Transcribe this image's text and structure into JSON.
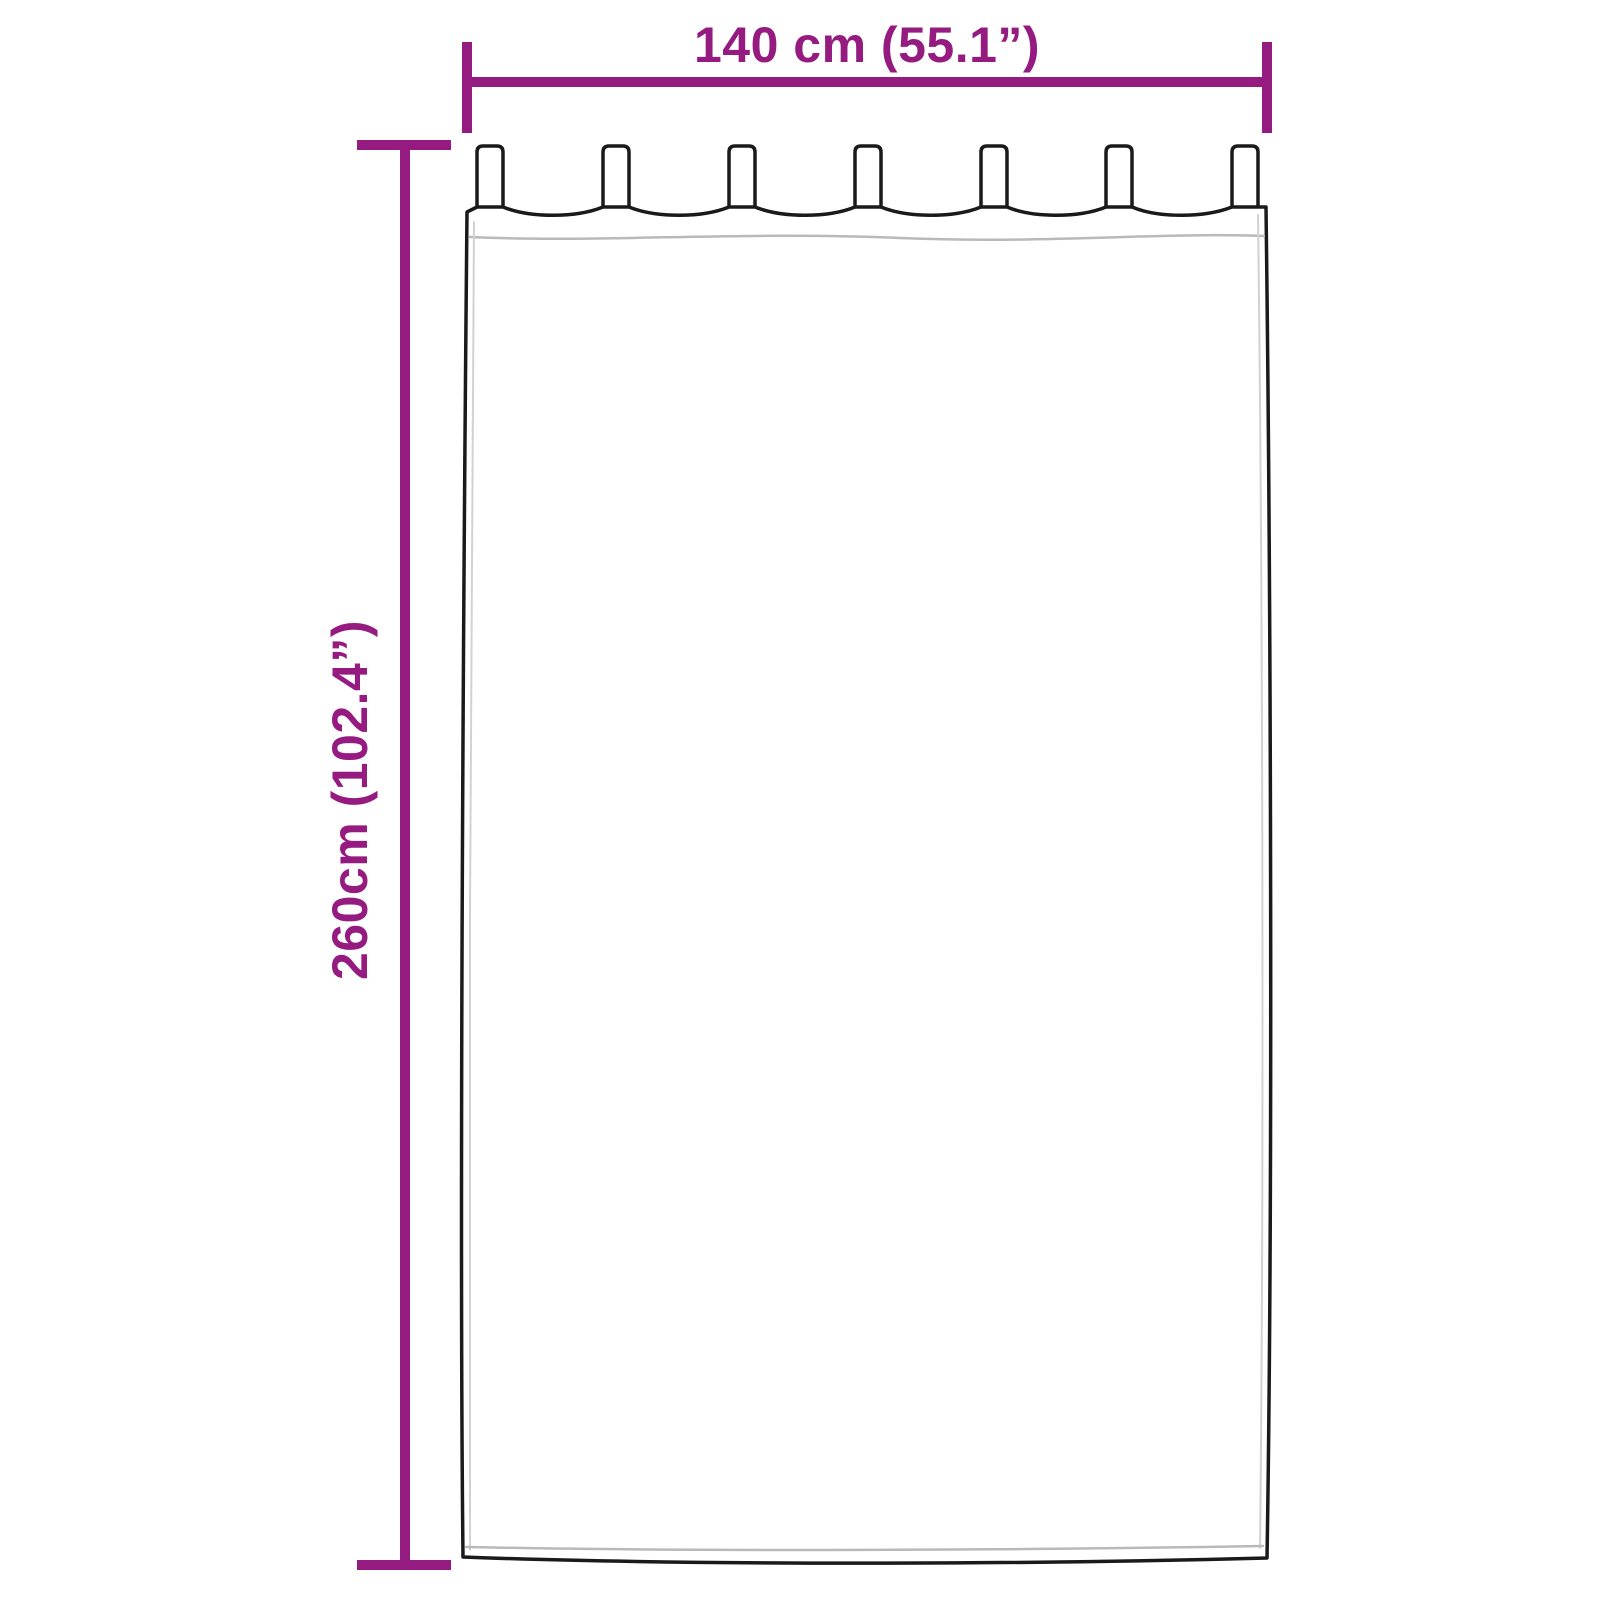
{
  "dimensions": {
    "width": {
      "label": "140 cm (55.1”)",
      "value_cm": 140,
      "value_in": 55.1
    },
    "height": {
      "label": "260cm (102.4”)",
      "value_cm": 260,
      "value_in": 102.4
    }
  },
  "curtain": {
    "tab_count": 7
  },
  "colors": {
    "dimension_accent": "#951b81",
    "outline": "#1a1a1a",
    "seam": "#b9b9b9",
    "background": "#ffffff"
  }
}
